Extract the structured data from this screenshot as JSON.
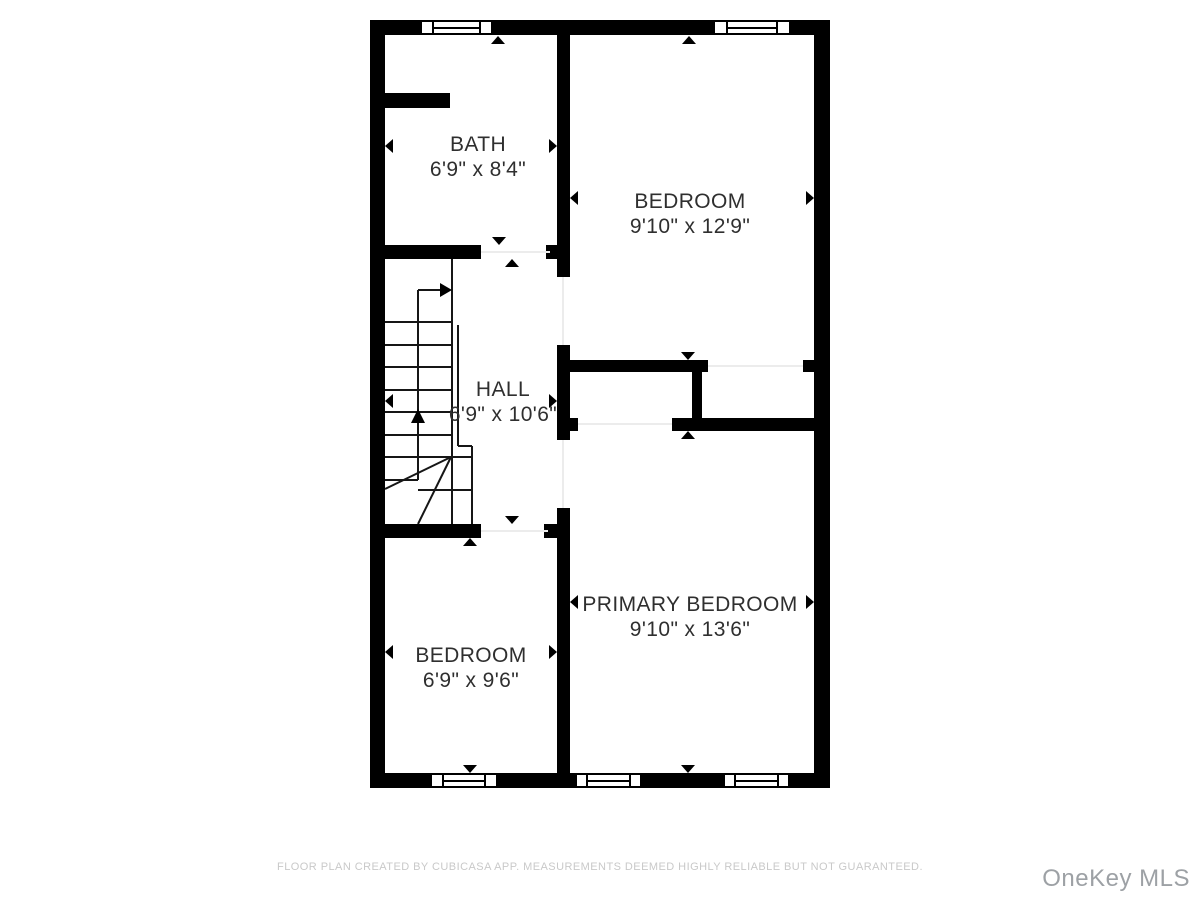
{
  "plan": {
    "rooms": [
      {
        "id": "bath",
        "name": "BATH",
        "dimensions": "6'9\" x 8'4\""
      },
      {
        "id": "bedroom-top",
        "name": "BEDROOM",
        "dimensions": "9'10\" x 12'9\""
      },
      {
        "id": "hall",
        "name": "HALL",
        "dimensions": "6'9\" x 10'6\""
      },
      {
        "id": "primary-bedroom",
        "name": "PRIMARY BEDROOM",
        "dimensions": "9'10\" x 13'6\""
      },
      {
        "id": "bedroom-bottom",
        "name": "BEDROOM",
        "dimensions": "6'9\" x 9'6\""
      }
    ],
    "features": [
      "staircase-with-winders",
      "up-direction-arrow",
      "5-windows",
      "measurement-arrows"
    ]
  },
  "footer": {
    "disclaimer": "FLOOR PLAN CREATED BY CUBICASA APP. MEASUREMENTS DEEMED HIGHLY RELIABLE BUT NOT GUARANTEED."
  },
  "watermark": {
    "text": "OneKey MLS"
  },
  "colors": {
    "wall": "#000000",
    "label_text": "#2f2f2f",
    "disclaimer_text": "#c9c9c9",
    "watermark_text": "#9da1a5",
    "background": "#ffffff"
  }
}
